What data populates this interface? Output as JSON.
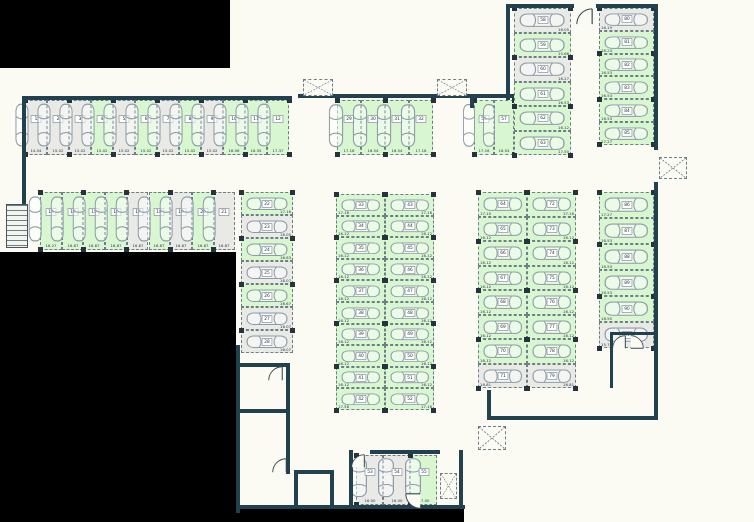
{
  "title": "Parking level floor plan",
  "colors": {
    "wall": "#21414f",
    "available_green": "#d8f6cf",
    "occupied_grey": "#e9e9e6",
    "stall_border": "#6d7e86",
    "car_outline": "#8d9ca8",
    "outside_black": "#000000",
    "background": "#fbfbf4"
  },
  "icons": {
    "car": "car-icon",
    "shaft": "shaft-x-icon",
    "stairs": "stairs-icon",
    "door": "door-arc-icon",
    "column": "column-marker"
  },
  "plan": {
    "blocks": {
      "row_top_left": {
        "stalls": [
          {
            "n": "1",
            "s": "14.04",
            "st": "x"
          },
          {
            "n": "2",
            "s": "15.02",
            "st": "x"
          },
          {
            "n": "3",
            "s": "15.02",
            "st": "x"
          },
          {
            "n": "4",
            "s": "15.02",
            "st": "g"
          },
          {
            "n": "5",
            "s": "15.02",
            "st": "x"
          },
          {
            "n": "6",
            "s": "15.02",
            "st": "g"
          },
          {
            "n": "7",
            "s": "15.02",
            "st": "x"
          },
          {
            "n": "8",
            "s": "15.02",
            "st": "g"
          },
          {
            "n": "9",
            "s": "15.02",
            "st": "x"
          },
          {
            "n": "10",
            "s": "16.06",
            "st": "g"
          },
          {
            "n": "11",
            "s": "16.35",
            "st": "g"
          },
          {
            "n": "12",
            "s": "17.37",
            "st": "g"
          }
        ]
      },
      "row_second": {
        "stalls": [
          {
            "n": "13",
            "s": "16.27",
            "st": "g"
          },
          {
            "n": "14",
            "s": "16.87",
            "st": "g"
          },
          {
            "n": "15",
            "s": "16.87",
            "st": "g"
          },
          {
            "n": "16",
            "s": "16.87",
            "st": "g"
          },
          {
            "n": "17",
            "s": "16.87",
            "st": "x"
          },
          {
            "n": "18",
            "s": "16.87",
            "st": "g"
          },
          {
            "n": "19",
            "s": "16.87",
            "st": "x"
          },
          {
            "n": "20",
            "s": "16.87",
            "st": "g"
          },
          {
            "n": "21",
            "s": "16.87",
            "st": "x"
          }
        ]
      },
      "col_left": {
        "stalls": [
          {
            "n": "22",
            "s": "17.16",
            "st": "g"
          },
          {
            "n": "23",
            "s": "16.00",
            "st": "x"
          },
          {
            "n": "24",
            "s": "16.63",
            "st": "g"
          },
          {
            "n": "25",
            "s": "16.07",
            "st": "x"
          },
          {
            "n": "26",
            "s": "16.67",
            "st": "g"
          },
          {
            "n": "27",
            "s": "16.07",
            "st": "x"
          },
          {
            "n": "28",
            "s": "16.07",
            "st": "x"
          }
        ]
      },
      "row_top_mid": {
        "stalls": [
          {
            "n": "29",
            "s": "17.16",
            "st": "g"
          },
          {
            "n": "30",
            "s": "16.54",
            "st": "g"
          },
          {
            "n": "31",
            "s": "16.54",
            "st": "g"
          },
          {
            "n": "32",
            "s": "17.16",
            "st": "g"
          }
        ]
      },
      "mid_left": {
        "stalls": [
          {
            "n": "33",
            "s": "17.16",
            "st": "g"
          },
          {
            "n": "34",
            "s": "16.12",
            "st": "g"
          },
          {
            "n": "35",
            "s": "16.12",
            "st": "g"
          },
          {
            "n": "36",
            "s": "16.12",
            "st": "g"
          },
          {
            "n": "37",
            "s": "16.12",
            "st": "g"
          },
          {
            "n": "38",
            "s": "16.12",
            "st": "g"
          },
          {
            "n": "39",
            "s": "16.12",
            "st": "g"
          },
          {
            "n": "40",
            "s": "16.12",
            "st": "g"
          },
          {
            "n": "41",
            "s": "16.12",
            "st": "g"
          },
          {
            "n": "42",
            "s": "17.58",
            "st": "g"
          }
        ]
      },
      "mid_right": {
        "stalls": [
          {
            "n": "43",
            "s": "17.16",
            "st": "g"
          },
          {
            "n": "44",
            "s": "16.12",
            "st": "g"
          },
          {
            "n": "45",
            "s": "16.12",
            "st": "g"
          },
          {
            "n": "46",
            "s": "16.12",
            "st": "g"
          },
          {
            "n": "47",
            "s": "16.12",
            "st": "g"
          },
          {
            "n": "48",
            "s": "16.12",
            "st": "g"
          },
          {
            "n": "49",
            "s": "16.12",
            "st": "g"
          },
          {
            "n": "50",
            "s": "16.12",
            "st": "g"
          },
          {
            "n": "51",
            "s": "16.12",
            "st": "g"
          },
          {
            "n": "52",
            "s": "17.16",
            "st": "g"
          }
        ]
      },
      "pair_56": {
        "stalls": [
          {
            "n": "56",
            "s": "17.16",
            "st": "g"
          },
          {
            "n": "57",
            "s": "16.54",
            "st": "g"
          }
        ]
      },
      "tr_left": {
        "stalls": [
          {
            "n": "58",
            "s": "16.05",
            "st": "x"
          },
          {
            "n": "59",
            "s": "15.66",
            "st": "g"
          },
          {
            "n": "60",
            "s": "16.27",
            "st": "x"
          },
          {
            "n": "61",
            "s": "16.53",
            "st": "g"
          },
          {
            "n": "62",
            "s": "16.12",
            "st": "g"
          },
          {
            "n": "63",
            "s": "17.50",
            "st": "g"
          }
        ]
      },
      "tr_right": {
        "stalls": [
          {
            "n": "80",
            "s": "16.19",
            "st": "x"
          },
          {
            "n": "81",
            "s": "16.23",
            "st": "g"
          },
          {
            "n": "82",
            "s": "16.53",
            "st": "g"
          },
          {
            "n": "83",
            "s": "16.53",
            "st": "g"
          },
          {
            "n": "84",
            "s": "16.53",
            "st": "g"
          },
          {
            "n": "85",
            "s": "17.27",
            "st": "g"
          }
        ]
      },
      "rm_left": {
        "stalls": [
          {
            "n": "64",
            "s": "17.10",
            "st": "g"
          },
          {
            "n": "65",
            "s": "16.12",
            "st": "g"
          },
          {
            "n": "66",
            "s": "16.12",
            "st": "g"
          },
          {
            "n": "67",
            "s": "16.12",
            "st": "g"
          },
          {
            "n": "68",
            "s": "16.12",
            "st": "g"
          },
          {
            "n": "69",
            "s": "16.12",
            "st": "g"
          },
          {
            "n": "70",
            "s": "16.12",
            "st": "g"
          },
          {
            "n": "71",
            "s": "16.81",
            "st": "x"
          }
        ]
      },
      "rm_right": {
        "stalls": [
          {
            "n": "72",
            "s": "17.16",
            "st": "g"
          },
          {
            "n": "73",
            "s": "16.12",
            "st": "g"
          },
          {
            "n": "74",
            "s": "16.12",
            "st": "g"
          },
          {
            "n": "75",
            "s": "16.12",
            "st": "g"
          },
          {
            "n": "76",
            "s": "16.12",
            "st": "g"
          },
          {
            "n": "77",
            "s": "16.12",
            "st": "g"
          },
          {
            "n": "78",
            "s": "16.12",
            "st": "g"
          },
          {
            "n": "79",
            "s": "16.81",
            "st": "x"
          }
        ]
      },
      "fr_col": {
        "stalls": [
          {
            "n": "86",
            "s": "17.27",
            "st": "g"
          },
          {
            "n": "87",
            "s": "16.53",
            "st": "g"
          },
          {
            "n": "88",
            "s": "16.53",
            "st": "g"
          },
          {
            "n": "89",
            "s": "16.53",
            "st": "g"
          },
          {
            "n": "90",
            "s": "16.50",
            "st": "g"
          },
          {
            "n": "91",
            "s": "15.76",
            "st": "x"
          }
        ]
      },
      "bottom_row": {
        "stalls": [
          {
            "n": "53",
            "s": "16.00",
            "st": "x"
          },
          {
            "n": "54",
            "s": "16.00",
            "st": "x"
          },
          {
            "n": "55",
            "s": "17.00",
            "st": "g"
          }
        ]
      }
    }
  }
}
